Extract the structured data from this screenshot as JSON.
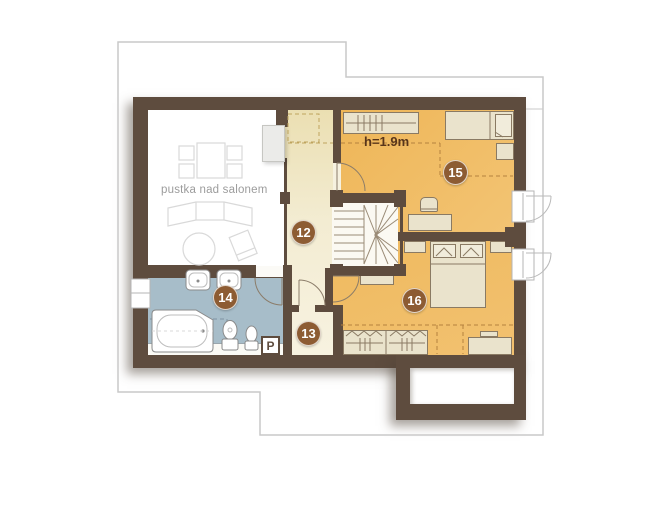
{
  "floorplan": {
    "rooms": [
      {
        "label": "12",
        "color": "#f2e9cf"
      },
      {
        "label": "13",
        "color": "#f2e9cf"
      },
      {
        "label": "14",
        "color": "#a7bdc9"
      },
      {
        "label": "15",
        "color": "#efb95e"
      },
      {
        "label": "16",
        "color": "#efb95e"
      }
    ],
    "annotations": {
      "void_label": "pustka nad salonem",
      "ceiling_height": "h=1.9m",
      "washer": "P"
    },
    "palette": {
      "wall": "#5e4c3e",
      "badge": "#8d5c33",
      "furniture": "#eae3cc",
      "stairs": "#fbf9f2",
      "roof_outline": "#c9c9c9"
    }
  }
}
